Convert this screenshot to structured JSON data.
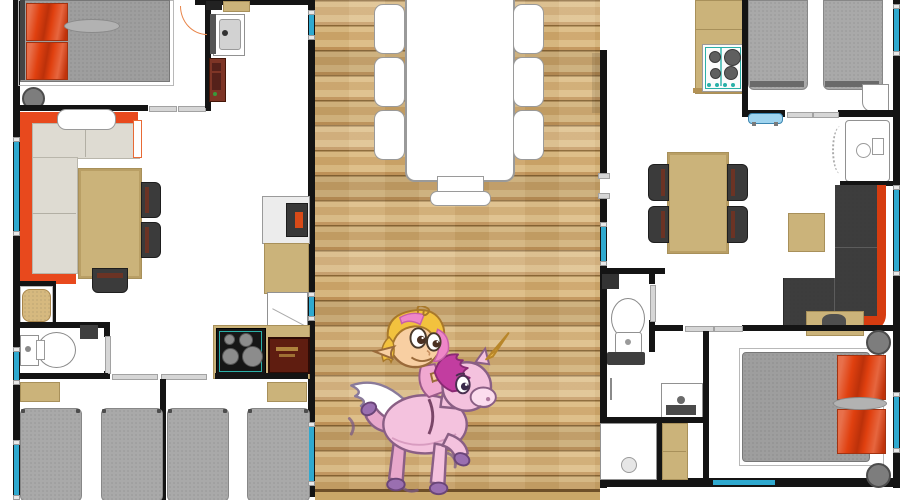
{
  "meta": {
    "image_type": "floor-plan",
    "description": "Top-down colour floor plan of a two-unit holiday lodge / mobile home joined by a central timber deck with outdoor dining set; a cartoon fairy riding a pink winged unicorn is overlaid on the deck.",
    "visible_text": "none (appliance branding illegible)"
  },
  "labels": {
    "left_unit": "Left lodge unit",
    "right_unit": "Right lodge unit",
    "deck": "Central wooden deck",
    "deck_table": "Outdoor dining table with six side chairs and end bench",
    "character": "Fairy girl riding a pink winged unicorn",
    "left_bedroom": "Double bedroom with orange pillows",
    "left_bathroom": "Washroom with vanity and cabinet",
    "left_living": "Living room with orange corner sofa and dining table",
    "left_wc": "WC with toilet and hand basin",
    "left_shower": "Shower cubicle",
    "left_kitchen": "Kitchen with gas hob and microwave",
    "left_bunkroom_1": "Twin bedroom (2 single beds)",
    "left_bunkroom_2": "Twin bedroom (2 single beds)",
    "right_kitchen": "Kitchen with gas hob",
    "right_twin_bedroom": "Twin bedroom (2 single beds)",
    "right_shower_room": "Shower room",
    "right_living": "Living-dining room with charcoal corner sofa",
    "right_wc": "WC",
    "right_bathroom": "Bathroom with shower, vanity and counter",
    "right_double_bedroom": "Double bedroom with red pillows"
  },
  "inventory": {
    "deck_chairs_per_side": 3,
    "deck_end_seats": 1,
    "left_unit_single_beds": 4,
    "left_unit_double_beds": 1,
    "right_unit_single_beds": 2,
    "right_unit_double_beds": 1,
    "dining_chairs_left_unit": 3,
    "dining_chairs_right_unit": 4,
    "hobs": 2,
    "toilets": 2,
    "showers": 3
  },
  "character": {
    "rider": "elf / fairy girl, blonde hair with pink streaks, pointed ear, big cartoon eyes",
    "mount": "pink unicorn-pegasus, purple-magenta mane, golden horn, white feathered wing, purple hooves",
    "pose": "prancing right with motion dashes near hooves"
  },
  "colors": {
    "wall": "#141414",
    "window": "#2fa9cf",
    "wood1": "#dcbc84",
    "wood2": "#cda66a",
    "wood3": "#c2955a",
    "woodline": "#8a6736",
    "bedgray": "#a9a9a9",
    "mattress": "#9e9e9e",
    "beige": "#cbb37a",
    "cushion": "#dedbd2",
    "sofaorange": "#e8491d",
    "pillow": "#e0400f",
    "chairdark": "#3b3b3b",
    "charcoal": "#3d3d3d",
    "sofared": "#d63c10",
    "hobblack": "#161616",
    "hobteal": "#2ab0a8",
    "microwave": "#5f1d10",
    "fixborder": "#919191",
    "unicornpink": "#f4c2de",
    "manepurple": "#c23da0",
    "horngold": "#e8b84a",
    "hairyellow": "#f2c23e",
    "hairpink": "#ee86c8",
    "skin": "#f8cfa2"
  }
}
